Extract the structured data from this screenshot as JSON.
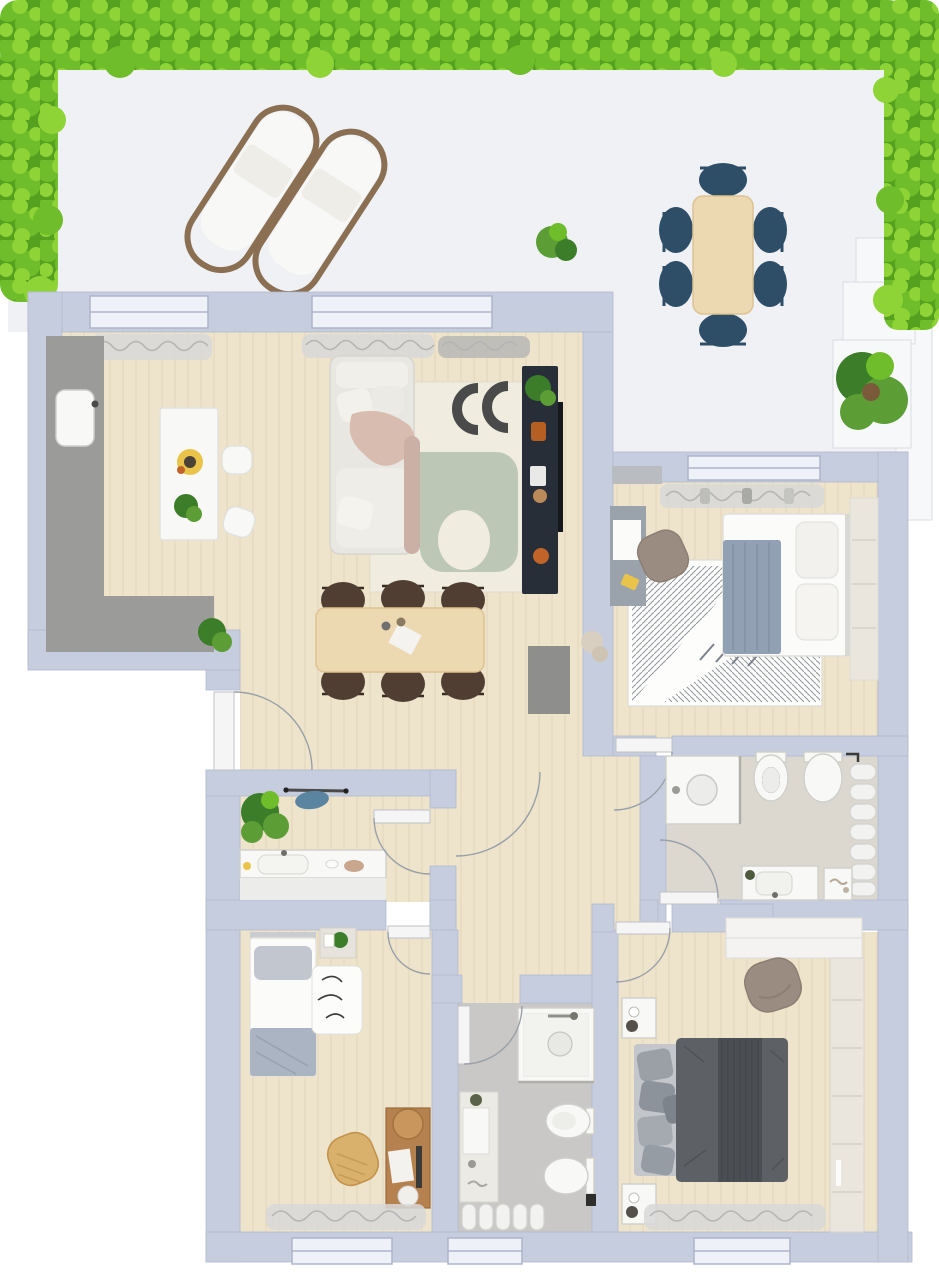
{
  "meta": {
    "title": "Top-down 3D floor plan of an apartment with wrap-around terrace",
    "view": "top-down 3D render",
    "visible_text": "none"
  },
  "colors": {
    "wall": "#c6cdde",
    "wall_dark": "#adb5ca",
    "window_pane": "#eef1f7",
    "terrace_floor": "#f0f1f4",
    "terrace_white": "#f7f8fa",
    "planter_shadow": "#d9dce3",
    "hedge_dark": "#55a01e",
    "hedge_mid": "#6fbd2a",
    "hedge_light": "#8ed437",
    "wood": "#eee3cb",
    "wood_line": "#e2d5b6",
    "bath1_floor": "#dcd8d0",
    "bath2_floor": "#c9c8c6",
    "white": "#f8f8f6",
    "white_shadow": "#e2e1dd",
    "navy": "#2e4d67",
    "table_wood": "#ecd9b2",
    "table_wood_edge": "#dcc391",
    "sofa": "#e9e7e1",
    "sofa_shadow": "#d7d5cf",
    "blanket_pink": "#d8bcb0",
    "rug_cream": "#f0ecdf",
    "rug_edge": "#e2ddcd",
    "rug_sage": "#bcc7b6",
    "rug_orange": "#ecc084",
    "rug_dark": "#4a4a4a",
    "rug_grid": "#8f959e",
    "tv_navy": "#272e38",
    "chair_brown": "#503e32",
    "counter_gray": "#9b9b99",
    "cabinet_gray": "#8e8e8c",
    "blanket_blue": "#92a0b4",
    "bed_white": "#fbfbf9",
    "master_duvet": "#5d6166",
    "master_duvet_dark": "#4b4f54",
    "pillow_gray": "#9aa0a6",
    "bed_base": "#c3c6cb",
    "wardrobe_cream": "#eae6de",
    "chair_taupe": "#9b8c82",
    "rattan": "#d9b16c",
    "desk_wood": "#b5824f",
    "desk_gray": "#9aa2ac",
    "curtain": "#d8d8d8",
    "curtain_dark": "#b4b4b4",
    "door": "#f5f5f5",
    "arc": "#9aa0a8",
    "radiator": "#f2f2f0",
    "radiator_shadow": "#d2d2cf",
    "plant_dark": "#3c7d2a",
    "plant_mid": "#5c9e35",
    "lounger_frame": "#8a6f52",
    "accent_yellow": "#e9c34a",
    "accent_orange": "#c0642a",
    "garment_blue": "#5b84a0"
  },
  "rooms": [
    {
      "name": "Terrace",
      "furniture": [
        "hedge planters on three sides",
        "2 sun loungers",
        "outdoor dining table",
        "6 navy outdoor chairs",
        "potted shrub",
        "small potted plant",
        "white planter steps"
      ]
    },
    {
      "name": "Living room with open kitchen",
      "furniture": [
        "L-shaped kitchen counter",
        "kitchen island with 2 stools",
        "flowers",
        "sofa with throw blanket",
        "abstract area rug",
        "navy media sideboard with TV",
        "dining table with 6 chairs",
        "gray cabinet",
        "entrance door",
        "2 terrace windows",
        "curtains"
      ]
    },
    {
      "name": "Bedroom 1",
      "furniture": [
        "double bed with blue throw",
        "geometric rug",
        "desk",
        "desk chair",
        "wardrobe",
        "window",
        "curtains",
        "door"
      ]
    },
    {
      "name": "Bathroom 1",
      "furniture": [
        "walk-in shower",
        "bidet",
        "wall-hung toilet",
        "towel radiator",
        "vanity with washbasin",
        "side cabinet",
        "door"
      ]
    },
    {
      "name": "Hallway",
      "furniture": [
        "door swing arcs"
      ]
    },
    {
      "name": "Entry / utility room",
      "furniture": [
        "monstera plant",
        "coat rail with garment",
        "washbasin cabinet",
        "door"
      ]
    },
    {
      "name": "Bedroom 2 (kids room)",
      "furniture": [
        "single bed",
        "nightstand with plant",
        "squiggle rug",
        "rattan armchair",
        "wooden desk",
        "round stool",
        "window",
        "curtains",
        "door"
      ]
    },
    {
      "name": "Bathroom 2",
      "furniture": [
        "shower",
        "vanity column with basin",
        "bidet",
        "toilet",
        "towel radiator",
        "window",
        "door"
      ]
    },
    {
      "name": "Master bedroom",
      "furniture": [
        "double bed with dark gray duvet",
        "2 nightstands",
        "lounge chair",
        "built-in wardrobe",
        "closet shelf",
        "window",
        "curtains",
        "door"
      ]
    }
  ]
}
